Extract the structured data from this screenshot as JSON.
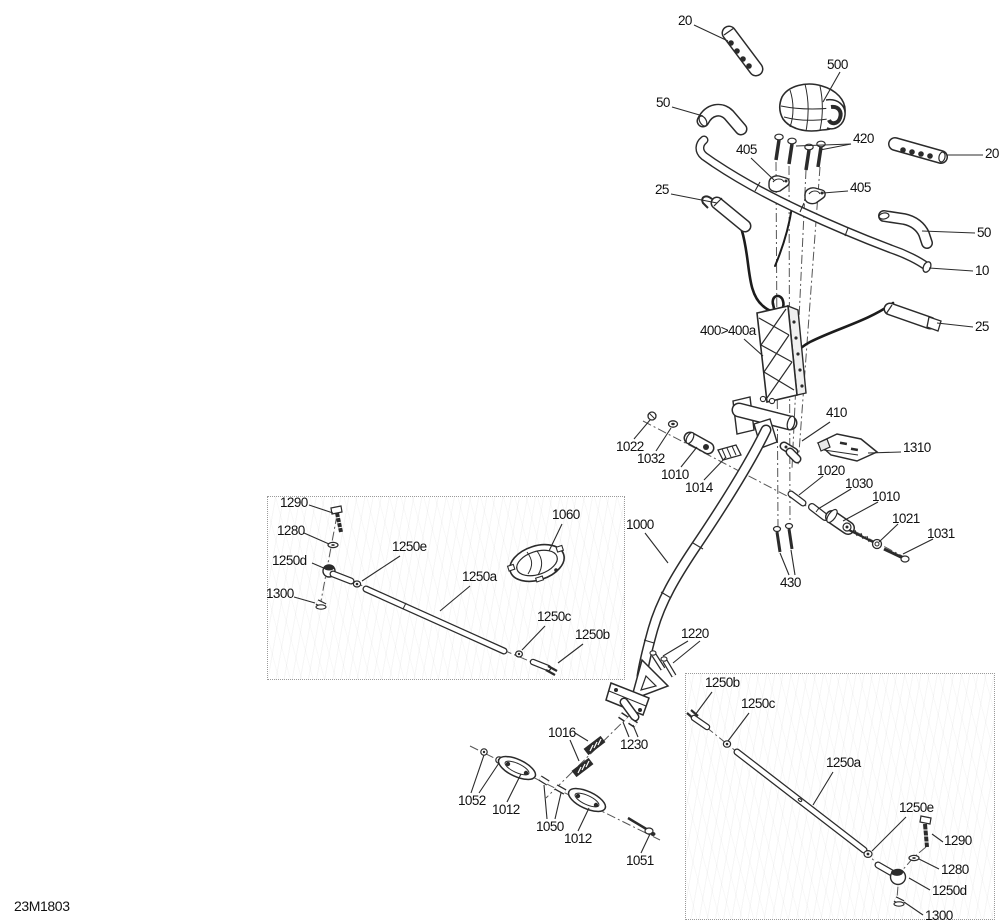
{
  "diagram": {
    "code": "23M1803",
    "canvas": {
      "width": 1000,
      "height": 924
    },
    "colors": {
      "background": "#ffffff",
      "part_line": "#2b2b2b",
      "label_text": "#111111",
      "centerline": "#555555",
      "box_border": "#9a9a9a"
    },
    "code_position": {
      "x": 14,
      "y": 899
    }
  },
  "detail_boxes": [
    {
      "name": "detail-box-left",
      "x": 267,
      "y": 496,
      "w": 358,
      "h": 184
    },
    {
      "name": "detail-box-right",
      "x": 685,
      "y": 673,
      "w": 310,
      "h": 247
    }
  ],
  "callouts": [
    {
      "name": "20-grip-left",
      "text": "20",
      "x": 678,
      "y": 14,
      "leaders": [
        [
          [
            694,
            25
          ],
          [
            728,
            41
          ]
        ]
      ]
    },
    {
      "name": "500-pad",
      "text": "500",
      "x": 827,
      "y": 58,
      "leaders": [
        [
          [
            840,
            72
          ],
          [
            823,
            102
          ]
        ]
      ]
    },
    {
      "name": "50-elbow-left",
      "text": "50",
      "x": 656,
      "y": 96,
      "leaders": [
        [
          [
            672,
            107
          ],
          [
            703,
            116
          ]
        ]
      ]
    },
    {
      "name": "420-screws",
      "text": "420",
      "x": 853,
      "y": 132,
      "leaders": [
        [
          [
            851,
            144
          ],
          [
            820,
            150
          ]
        ],
        [
          [
            851,
            144
          ],
          [
            796,
            146
          ]
        ]
      ]
    },
    {
      "name": "405-clamp-upper",
      "text": "405",
      "x": 736,
      "y": 143,
      "leaders": [
        [
          [
            751,
            158
          ],
          [
            774,
            180
          ]
        ]
      ]
    },
    {
      "name": "20-grip-right",
      "text": "20",
      "x": 985,
      "y": 147,
      "leaders": [
        [
          [
            983,
            155
          ],
          [
            947,
            155
          ]
        ]
      ]
    },
    {
      "name": "405-clamp-lower",
      "text": "405",
      "x": 850,
      "y": 181,
      "leaders": [
        [
          [
            848,
            191
          ],
          [
            823,
            193
          ]
        ]
      ]
    },
    {
      "name": "25-grip-left",
      "text": "25",
      "x": 655,
      "y": 183,
      "leaders": [
        [
          [
            671,
            194
          ],
          [
            717,
            203
          ]
        ]
      ]
    },
    {
      "name": "50-elbow-right",
      "text": "50",
      "x": 977,
      "y": 226,
      "leaders": [
        [
          [
            975,
            233
          ],
          [
            922,
            231
          ]
        ]
      ]
    },
    {
      "name": "10-handlebar",
      "text": "10",
      "x": 975,
      "y": 264,
      "leaders": [
        [
          [
            973,
            271
          ],
          [
            929,
            268
          ]
        ]
      ]
    },
    {
      "name": "25-grip-right",
      "text": "25",
      "x": 975,
      "y": 320,
      "leaders": [
        [
          [
            973,
            327
          ],
          [
            937,
            323
          ]
        ]
      ]
    },
    {
      "name": "400-400a-riser",
      "text": "400>400a",
      "x": 700,
      "y": 324,
      "leaders": [
        [
          [
            744,
            339
          ],
          [
            763,
            356
          ]
        ]
      ]
    },
    {
      "name": "410-clamp",
      "text": "410",
      "x": 826,
      "y": 406,
      "leaders": [
        [
          [
            830,
            422
          ],
          [
            802,
            441
          ]
        ]
      ]
    },
    {
      "name": "1310-bracket",
      "text": "1310",
      "x": 903,
      "y": 441,
      "leaders": [
        [
          [
            901,
            452
          ],
          [
            868,
            453
          ]
        ]
      ]
    },
    {
      "name": "1022-nut",
      "text": "1022",
      "x": 616,
      "y": 440,
      "leaders": [
        [
          [
            634,
            439
          ],
          [
            650,
            420
          ]
        ]
      ]
    },
    {
      "name": "1032-washer",
      "text": "1032",
      "x": 637,
      "y": 452,
      "leaders": [
        [
          [
            656,
            451
          ],
          [
            671,
            428
          ]
        ]
      ]
    },
    {
      "name": "1010-block-left",
      "text": "1010",
      "x": 661,
      "y": 468,
      "leaders": [
        [
          [
            681,
            467
          ],
          [
            697,
            447
          ]
        ]
      ]
    },
    {
      "name": "1014-plate",
      "text": "1014",
      "x": 685,
      "y": 481,
      "leaders": [
        [
          [
            704,
            480
          ],
          [
            726,
            457
          ]
        ]
      ]
    },
    {
      "name": "1020-pin",
      "text": "1020",
      "x": 817,
      "y": 464,
      "leaders": [
        [
          [
            823,
            476
          ],
          [
            799,
            495
          ]
        ]
      ]
    },
    {
      "name": "1030-sleeve",
      "text": "1030",
      "x": 845,
      "y": 477,
      "leaders": [
        [
          [
            851,
            489
          ],
          [
            818,
            509
          ]
        ]
      ]
    },
    {
      "name": "1010-block-right",
      "text": "1010",
      "x": 872,
      "y": 490,
      "leaders": [
        [
          [
            878,
            502
          ],
          [
            843,
            521
          ]
        ]
      ]
    },
    {
      "name": "1021-nut",
      "text": "1021",
      "x": 892,
      "y": 512,
      "leaders": [
        [
          [
            898,
            524
          ],
          [
            879,
            542
          ]
        ]
      ]
    },
    {
      "name": "1031-bolt",
      "text": "1031",
      "x": 927,
      "y": 527,
      "leaders": [
        [
          [
            933,
            539
          ],
          [
            903,
            554
          ]
        ]
      ]
    },
    {
      "name": "430-bolts",
      "text": "430",
      "x": 780,
      "y": 576,
      "leaders": [
        [
          [
            789,
            575
          ],
          [
            780,
            553
          ]
        ],
        [
          [
            795,
            575
          ],
          [
            791,
            550
          ]
        ]
      ]
    },
    {
      "name": "1290-bolt-left",
      "text": "1290",
      "x": 280,
      "y": 496,
      "leaders": [
        [
          [
            309,
            505
          ],
          [
            333,
            513
          ]
        ]
      ]
    },
    {
      "name": "1280-washer-left",
      "text": "1280",
      "x": 277,
      "y": 524,
      "leaders": [
        [
          [
            304,
            533
          ],
          [
            329,
            544
          ]
        ]
      ]
    },
    {
      "name": "1250e-nut-left",
      "text": "1250e",
      "x": 392,
      "y": 540,
      "leaders": [
        [
          [
            400,
            556
          ],
          [
            362,
            581
          ]
        ]
      ]
    },
    {
      "name": "1250d-rodend-left",
      "text": "1250d",
      "x": 272,
      "y": 554,
      "leaders": [
        [
          [
            312,
            563
          ],
          [
            326,
            569
          ]
        ]
      ]
    },
    {
      "name": "1300-nut-left",
      "text": "1300",
      "x": 266,
      "y": 587,
      "leaders": [
        [
          [
            294,
            597
          ],
          [
            315,
            603
          ]
        ]
      ]
    },
    {
      "name": "1060-cap",
      "text": "1060",
      "x": 552,
      "y": 508,
      "leaders": [
        [
          [
            562,
            524
          ],
          [
            549,
            551
          ]
        ]
      ]
    },
    {
      "name": "1250a-rod-left",
      "text": "1250a",
      "x": 462,
      "y": 570,
      "leaders": [
        [
          [
            470,
            586
          ],
          [
            440,
            611
          ]
        ]
      ]
    },
    {
      "name": "1000-column",
      "text": "1000",
      "x": 626,
      "y": 518,
      "leaders": [
        [
          [
            645,
            533
          ],
          [
            668,
            563
          ]
        ]
      ]
    },
    {
      "name": "1250c-washer-left",
      "text": "1250c",
      "x": 537,
      "y": 610,
      "leaders": [
        [
          [
            545,
            626
          ],
          [
            522,
            650
          ]
        ]
      ]
    },
    {
      "name": "1250b-balljoint-left",
      "text": "1250b",
      "x": 575,
      "y": 628,
      "leaders": [
        [
          [
            583,
            644
          ],
          [
            558,
            663
          ]
        ]
      ]
    },
    {
      "name": "1220-bolts",
      "text": "1220",
      "x": 681,
      "y": 627,
      "leaders": [
        [
          [
            688,
            641
          ],
          [
            663,
            656
          ]
        ],
        [
          [
            700,
            641
          ],
          [
            673,
            663
          ]
        ]
      ]
    },
    {
      "name": "1250b-balljoint-right",
      "text": "1250b",
      "x": 705,
      "y": 676,
      "leaders": [
        [
          [
            712,
            692
          ],
          [
            695,
            715
          ]
        ]
      ]
    },
    {
      "name": "1250c-washer-right",
      "text": "1250c",
      "x": 741,
      "y": 697,
      "leaders": [
        [
          [
            749,
            713
          ],
          [
            728,
            741
          ]
        ]
      ]
    },
    {
      "name": "1016-plates",
      "text": "1016",
      "x": 548,
      "y": 726,
      "leaders": [
        [
          [
            575,
            733
          ],
          [
            588,
            741
          ]
        ],
        [
          [
            570,
            740
          ],
          [
            579,
            761
          ]
        ]
      ]
    },
    {
      "name": "1230-nuts",
      "text": "1230",
      "x": 620,
      "y": 738,
      "leaders": [
        [
          [
            629,
            737
          ],
          [
            623,
            722
          ]
        ],
        [
          [
            638,
            737
          ],
          [
            633,
            725
          ]
        ]
      ]
    },
    {
      "name": "1250a-rod-right",
      "text": "1250a",
      "x": 826,
      "y": 756,
      "leaders": [
        [
          [
            833,
            772
          ],
          [
            813,
            805
          ]
        ]
      ]
    },
    {
      "name": "1052-screws",
      "text": "1052",
      "x": 458,
      "y": 794,
      "leaders": [
        [
          [
            471,
            793
          ],
          [
            484,
            755
          ]
        ],
        [
          [
            479,
            793
          ],
          [
            499,
            763
          ]
        ]
      ]
    },
    {
      "name": "1012-plate-a",
      "text": "1012",
      "x": 492,
      "y": 803,
      "leaders": [
        [
          [
            507,
            802
          ],
          [
            521,
            774
          ]
        ]
      ]
    },
    {
      "name": "1250e-nut-right",
      "text": "1250e",
      "x": 899,
      "y": 801,
      "leaders": [
        [
          [
            906,
            817
          ],
          [
            872,
            851
          ]
        ]
      ]
    },
    {
      "name": "1050-sleeves",
      "text": "1050",
      "x": 536,
      "y": 820,
      "leaders": [
        [
          [
            547,
            819
          ],
          [
            544,
            785
          ]
        ],
        [
          [
            555,
            819
          ],
          [
            561,
            793
          ]
        ]
      ]
    },
    {
      "name": "1012-plate-b",
      "text": "1012",
      "x": 564,
      "y": 832,
      "leaders": [
        [
          [
            578,
            831
          ],
          [
            589,
            808
          ]
        ]
      ]
    },
    {
      "name": "1290-bolt-right",
      "text": "1290",
      "x": 944,
      "y": 834,
      "leaders": [
        [
          [
            943,
            842
          ],
          [
            932,
            834
          ]
        ]
      ]
    },
    {
      "name": "1051-bolt",
      "text": "1051",
      "x": 626,
      "y": 854,
      "leaders": [
        [
          [
            641,
            853
          ],
          [
            650,
            834
          ]
        ]
      ]
    },
    {
      "name": "1280-washer-right",
      "text": "1280",
      "x": 941,
      "y": 863,
      "leaders": [
        [
          [
            939,
            869
          ],
          [
            919,
            859
          ]
        ]
      ]
    },
    {
      "name": "1250d-rodend-right",
      "text": "1250d",
      "x": 932,
      "y": 884,
      "leaders": [
        [
          [
            930,
            890
          ],
          [
            909,
            878
          ]
        ]
      ]
    },
    {
      "name": "1300-nut-right",
      "text": "1300",
      "x": 925,
      "y": 909,
      "leaders": [
        [
          [
            923,
            915
          ],
          [
            904,
            902
          ]
        ]
      ]
    }
  ]
}
